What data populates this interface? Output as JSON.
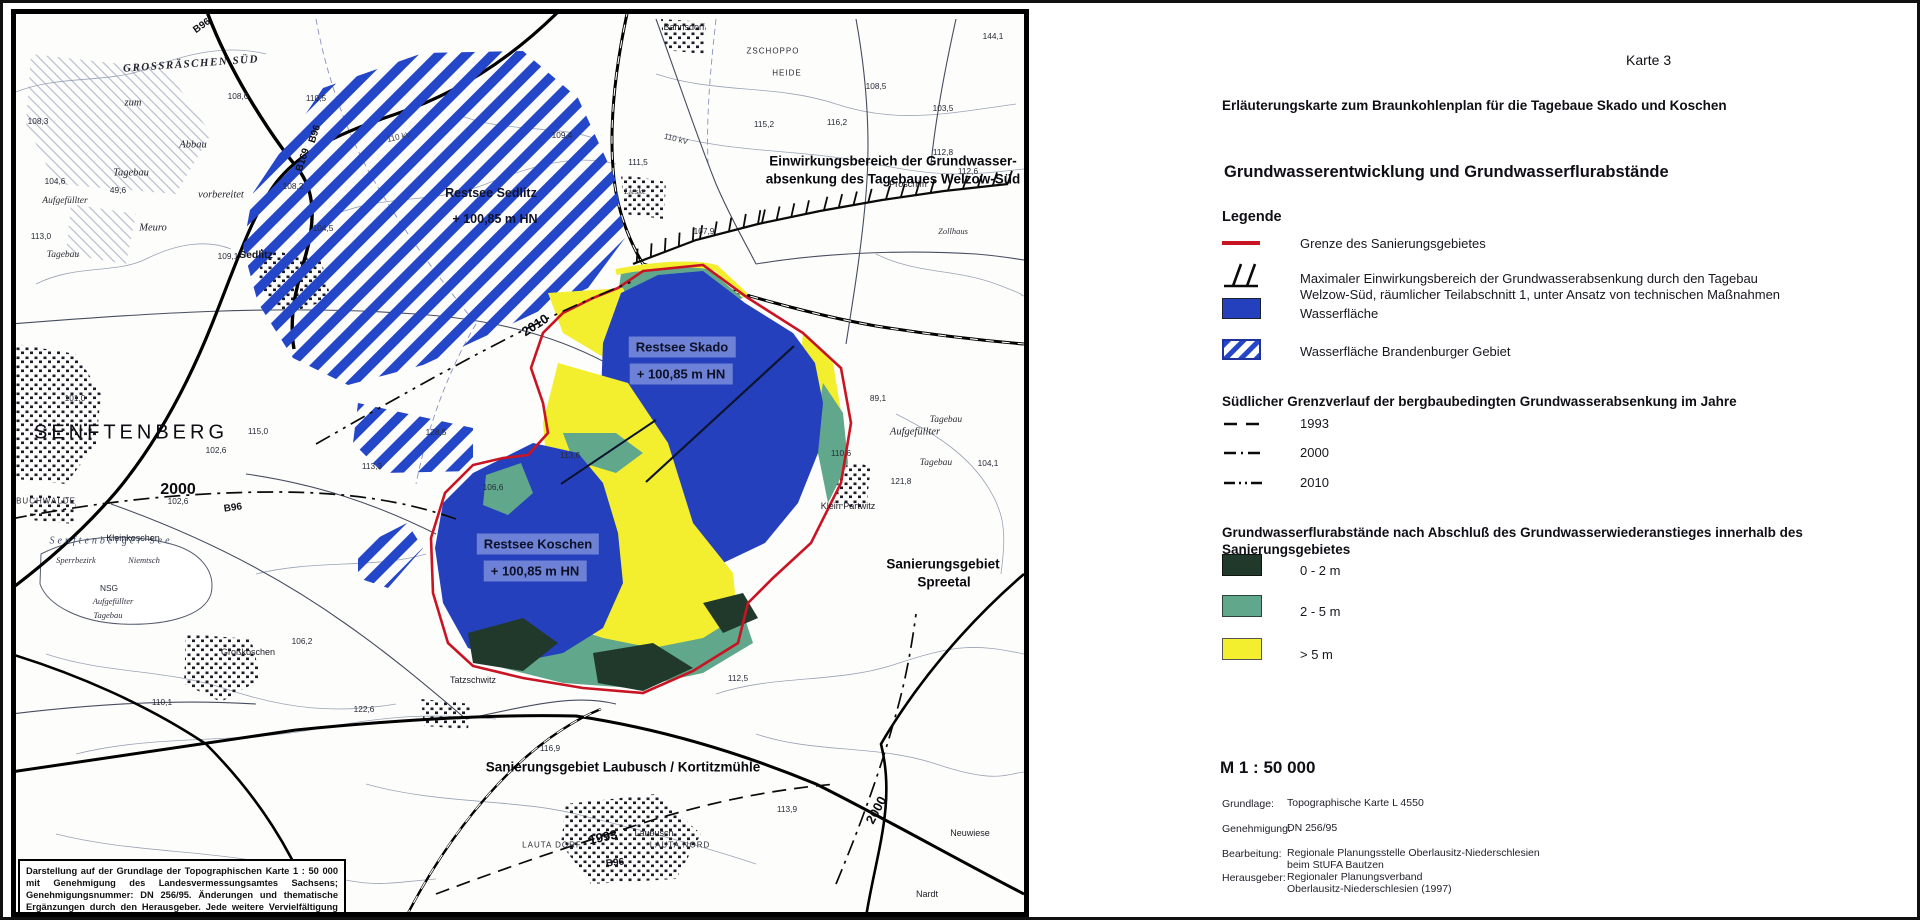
{
  "legend": {
    "karte": "Karte 3",
    "subtitle": "Erläuterungskarte zum Braunkohlenplan für die Tagebaue Skado und Koschen",
    "title": "Grundwasserentwicklung und Grundwasserflurabstände",
    "legende": "Legende",
    "grenze_label": "Grenze des Sanierungsgebietes",
    "einwirkung_line1": "Maximaler Einwirkungsbereich der Grundwasserabsenkung durch den Tagebau",
    "einwirkung_line2": "Welzow-Süd, räumlicher Teilabschnitt 1, unter Ansatz von technischen Maßnahmen",
    "wasser_label": "Wasserfläche",
    "wasser_bb_label": "Wasserfläche Brandenburger Gebiet",
    "south_heading": "Südlicher Grenzverlauf der bergbaubedingten Grundwasserabsenkung im Jahre",
    "year_1993": "1993",
    "year_2000": "2000",
    "year_2010": "2010",
    "flur_line1": "Grundwasserflurabstände nach Abschluß des Grundwasserwiederanstieges innerhalb des",
    "flur_line2": "Sanierungsgebietes",
    "depth_0_2": "0 - 2 m",
    "depth_2_5": "2 - 5 m",
    "depth_gt5": "> 5 m",
    "scale": "M 1 : 50 000",
    "credits": [
      {
        "key": "Grundlage:",
        "v1": "Topographische Karte L 4550",
        "v2": ""
      },
      {
        "key": "Genehmigung:",
        "v1": "DN 256/95",
        "v2": ""
      },
      {
        "key": "Bearbeitung:",
        "v1": "Regionale Planungsstelle Oberlausitz-Niederschlesien",
        "v2": "beim StUFA Bautzen"
      },
      {
        "key": "Herausgeber:",
        "v1": "Regionaler Planungsverband",
        "v2": "Oberlausitz-Niederschlesien (1997)"
      }
    ],
    "colors": {
      "boundary_red": "#c81423",
      "water": "#2540bc",
      "water_hatch": "#2446c8",
      "depth_0_2": "#21392a",
      "depth_2_5": "#60a78c",
      "depth_gt5": "#f3ef2e"
    }
  },
  "map": {
    "disclaimer": "Darstellung auf der Grundlage der Topographischen Karte 1 : 50 000 mit Genehmigung des Landesvermessungsamtes Sachsens; Genehmigungsnummer: DN 256/95. Änderungen und thematische Ergänzungen durch den Herausgeber. Jede weitere Vervielfältigung bedarf der Erlaubnis des Landesvermessungsamtes Sachsens.",
    "labels": [
      {
        "t": "SENFTENBERG",
        "x": 115,
        "y": 419,
        "c": "city"
      },
      {
        "t": "Sedlitz",
        "x": 240,
        "y": 241,
        "c": "town"
      },
      {
        "t": "GROSSRÄSCHEN SÜD",
        "x": 175,
        "y": 50,
        "c": "caps",
        "r": -4
      },
      {
        "t": "Bahnsdorf",
        "x": 668,
        "y": 13,
        "c": "twn9"
      },
      {
        "t": "ZSCHOPPO",
        "x": 757,
        "y": 37,
        "c": "capsS"
      },
      {
        "t": "HEIDE",
        "x": 771,
        "y": 59,
        "c": "capsS"
      },
      {
        "t": "Proschim",
        "x": 892,
        "y": 170,
        "c": "twn9"
      },
      {
        "t": "Lieske",
        "x": 619,
        "y": 177,
        "c": "it8"
      },
      {
        "t": "Zollhaus",
        "x": 937,
        "y": 217,
        "c": "it8"
      },
      {
        "t": "Kleinkoschen",
        "x": 117,
        "y": 524,
        "c": "twn9"
      },
      {
        "t": "BUCHWALDE",
        "x": 30,
        "y": 487,
        "c": "capsS"
      },
      {
        "t": "Großkoschen",
        "x": 232,
        "y": 638,
        "c": "twn9"
      },
      {
        "t": "Tatzschwitz",
        "x": 457,
        "y": 666,
        "c": "twn9"
      },
      {
        "t": "Klein Partwitz",
        "x": 832,
        "y": 492,
        "c": "twn9"
      },
      {
        "t": "Laubusch",
        "x": 638,
        "y": 819,
        "c": "twn9"
      },
      {
        "t": "Neuwiese",
        "x": 954,
        "y": 819,
        "c": "twn9"
      },
      {
        "t": "LAUTA DORF",
        "x": 536,
        "y": 831,
        "c": "capsS"
      },
      {
        "t": "LAUTA NORD",
        "x": 664,
        "y": 831,
        "c": "capsS"
      },
      {
        "t": "Nardt",
        "x": 911,
        "y": 880,
        "c": "twn9"
      },
      {
        "t": "zum",
        "x": 117,
        "y": 89,
        "c": "it10"
      },
      {
        "t": "Abbau",
        "x": 177,
        "y": 131,
        "c": "it10"
      },
      {
        "t": "Tagebau",
        "x": 115,
        "y": 159,
        "c": "it10"
      },
      {
        "t": "vorbereitet",
        "x": 205,
        "y": 181,
        "c": "it10"
      },
      {
        "t": "Aufgefüllter",
        "x": 49,
        "y": 187,
        "c": "it9"
      },
      {
        "t": "Meuro",
        "x": 137,
        "y": 214,
        "c": "it10"
      },
      {
        "t": "Tagebau",
        "x": 47,
        "y": 241,
        "c": "it9"
      },
      {
        "t": "Aufgefüllter",
        "x": 899,
        "y": 418,
        "c": "it10"
      },
      {
        "t": "Tagebau",
        "x": 930,
        "y": 406,
        "c": "it9"
      },
      {
        "t": "Tagebau",
        "x": 920,
        "y": 449,
        "c": "it9"
      },
      {
        "t": "Aufgefüllter",
        "x": 97,
        "y": 587,
        "c": "it8"
      },
      {
        "t": "Tagebau",
        "x": 92,
        "y": 601,
        "c": "it8"
      },
      {
        "t": "NSG",
        "x": 93,
        "y": 574,
        "c": "num"
      },
      {
        "t": "Senftenberger See",
        "x": 95,
        "y": 527,
        "c": "see"
      },
      {
        "t": "Sperrbezirk",
        "x": 60,
        "y": 546,
        "c": "it8"
      },
      {
        "t": "Niemtsch",
        "x": 128,
        "y": 546,
        "c": "it8"
      },
      {
        "t": "144,1",
        "x": 977,
        "y": 22,
        "c": "num"
      },
      {
        "t": "103,5",
        "x": 927,
        "y": 94,
        "c": "num"
      },
      {
        "t": "108,5",
        "x": 860,
        "y": 72,
        "c": "num"
      },
      {
        "t": "109,4",
        "x": 546,
        "y": 121,
        "c": "num"
      },
      {
        "t": "115,2",
        "x": 748,
        "y": 110,
        "c": "num"
      },
      {
        "t": "116,2",
        "x": 821,
        "y": 108,
        "c": "num"
      },
      {
        "t": "111,5",
        "x": 622,
        "y": 148,
        "c": "num"
      },
      {
        "t": "112,6",
        "x": 952,
        "y": 157,
        "c": "num"
      },
      {
        "t": "112,8",
        "x": 927,
        "y": 138,
        "c": "num"
      },
      {
        "t": "107,9",
        "x": 688,
        "y": 217,
        "c": "num"
      },
      {
        "t": "110,5",
        "x": 300,
        "y": 84,
        "c": "num"
      },
      {
        "t": "108,6",
        "x": 222,
        "y": 82,
        "c": "num"
      },
      {
        "t": "108,2",
        "x": 277,
        "y": 172,
        "c": "num"
      },
      {
        "t": "104,5",
        "x": 307,
        "y": 214,
        "c": "num"
      },
      {
        "t": "109,1",
        "x": 212,
        "y": 242,
        "c": "num"
      },
      {
        "t": "108,3",
        "x": 22,
        "y": 107,
        "c": "num"
      },
      {
        "t": "104,6",
        "x": 39,
        "y": 167,
        "c": "num"
      },
      {
        "t": "49,6",
        "x": 102,
        "y": 176,
        "c": "num"
      },
      {
        "t": "113,0",
        "x": 25,
        "y": 222,
        "c": "num"
      },
      {
        "t": "101,0",
        "x": 59,
        "y": 384,
        "c": "num"
      },
      {
        "t": "115,0",
        "x": 242,
        "y": 417,
        "c": "num"
      },
      {
        "t": "102,6",
        "x": 200,
        "y": 436,
        "c": "num"
      },
      {
        "t": "102,6",
        "x": 162,
        "y": 487,
        "c": "num"
      },
      {
        "t": "106,2",
        "x": 286,
        "y": 627,
        "c": "num"
      },
      {
        "t": "110,1",
        "x": 146,
        "y": 688,
        "c": "num"
      },
      {
        "t": "122,6",
        "x": 348,
        "y": 695,
        "c": "num"
      },
      {
        "t": "112,5",
        "x": 722,
        "y": 664,
        "c": "num"
      },
      {
        "t": "113,9",
        "x": 771,
        "y": 795,
        "c": "num"
      },
      {
        "t": "116,9",
        "x": 534,
        "y": 734,
        "c": "num"
      },
      {
        "t": "128,5",
        "x": 420,
        "y": 418,
        "c": "num"
      },
      {
        "t": "113,3",
        "x": 356,
        "y": 452,
        "c": "num"
      },
      {
        "t": "113,6",
        "x": 554,
        "y": 441,
        "c": "num"
      },
      {
        "t": "106,6",
        "x": 477,
        "y": 473,
        "c": "num"
      },
      {
        "t": "89,1",
        "x": 862,
        "y": 384,
        "c": "num"
      },
      {
        "t": "110,6",
        "x": 825,
        "y": 439,
        "c": "num"
      },
      {
        "t": "121,8",
        "x": 885,
        "y": 467,
        "c": "num"
      },
      {
        "t": "104,1",
        "x": 972,
        "y": 449,
        "c": "num"
      },
      {
        "t": "B96",
        "x": 186,
        "y": 12,
        "c": "road",
        "r": -35
      },
      {
        "t": "B96",
        "x": 217,
        "y": 494,
        "c": "road",
        "r": -8
      },
      {
        "t": "B96",
        "x": 599,
        "y": 849,
        "c": "road",
        "r": -6
      },
      {
        "t": "B169",
        "x": 287,
        "y": 146,
        "c": "road",
        "r": -72
      },
      {
        "t": "B96",
        "x": 299,
        "y": 120,
        "c": "road",
        "r": -72
      },
      {
        "t": "110 kV",
        "x": 383,
        "y": 123,
        "c": "kv",
        "r": -13
      },
      {
        "t": "110 kV",
        "x": 660,
        "y": 125,
        "c": "kv",
        "r": 14
      },
      {
        "t": "Einwirkungsbereich der Grundwasser-",
        "x": 877,
        "y": 147,
        "c": "bold13"
      },
      {
        "t": "absenkung des Tagebaues Welzow-Süd",
        "x": 877,
        "y": 165,
        "c": "bold13"
      },
      {
        "t": "Restsee Sedlitz",
        "x": 475,
        "y": 179,
        "c": "bold12"
      },
      {
        "t": "+ 100,85 m HN",
        "x": 479,
        "y": 205,
        "c": "bold12"
      },
      {
        "t": "Restsee Skado",
        "x": 666,
        "y": 333,
        "c": "lake"
      },
      {
        "t": "+ 100,85 m HN",
        "x": 665,
        "y": 360,
        "c": "lake"
      },
      {
        "t": "Restsee Koschen",
        "x": 522,
        "y": 530,
        "c": "lake"
      },
      {
        "t": "+ 100,85 m HN",
        "x": 519,
        "y": 557,
        "c": "lake"
      },
      {
        "t": "Sanierungsgebiet",
        "x": 927,
        "y": 550,
        "c": "bold13"
      },
      {
        "t": "Spreetal",
        "x": 928,
        "y": 568,
        "c": "bold13"
      },
      {
        "t": "Sanierungsgebiet Laubusch / Kortitzmühle",
        "x": 607,
        "y": 753,
        "c": "bold13"
      },
      {
        "t": "2000",
        "x": 162,
        "y": 476,
        "c": "yr16"
      },
      {
        "t": "2010",
        "x": 519,
        "y": 311,
        "c": "yr13",
        "r": -33
      },
      {
        "t": "1993",
        "x": 587,
        "y": 823,
        "c": "yr13",
        "r": -12
      },
      {
        "t": "2000",
        "x": 860,
        "y": 796,
        "c": "yr13",
        "r": -62
      }
    ]
  }
}
